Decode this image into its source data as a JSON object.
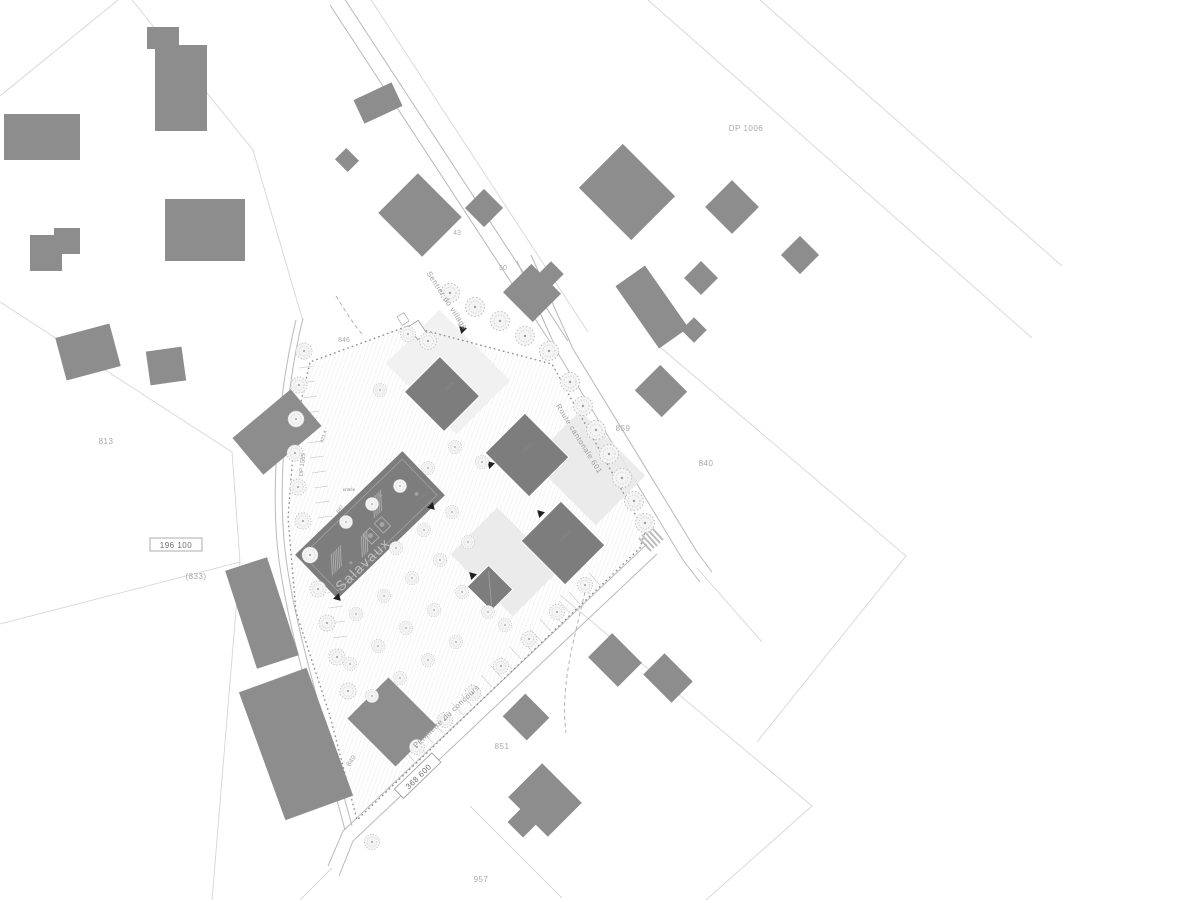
{
  "colors": {
    "context_building": "#8d8d8d",
    "new_building": "#7d7d7d",
    "parcel_line": "#d6d6d6",
    "annotation_text": "#a3a3a3"
  },
  "labels": {
    "dp1006": "DP 1006",
    "dp1565": "DP 1565",
    "p813": "813",
    "p833": "(833)",
    "p840": "840",
    "p846": "846",
    "p847": "847",
    "p849": "849",
    "p851": "851",
    "p859": "859",
    "p957": "957",
    "p43": "43",
    "p50": "50",
    "coord_north": "196 100",
    "coord_east": "368 600",
    "street_village": "Sentier du village",
    "street_route": "Route cantonale 601",
    "perimeter": "Périmètre du concours",
    "watermark": "Salavaux",
    "dim_west": "421.4",
    "entrance": "entrée",
    "level_b1": "+ 434.5",
    "level_b2": "+ 434.5",
    "level_b3": "+ 434.5",
    "level_b4": "+ 434.5"
  }
}
